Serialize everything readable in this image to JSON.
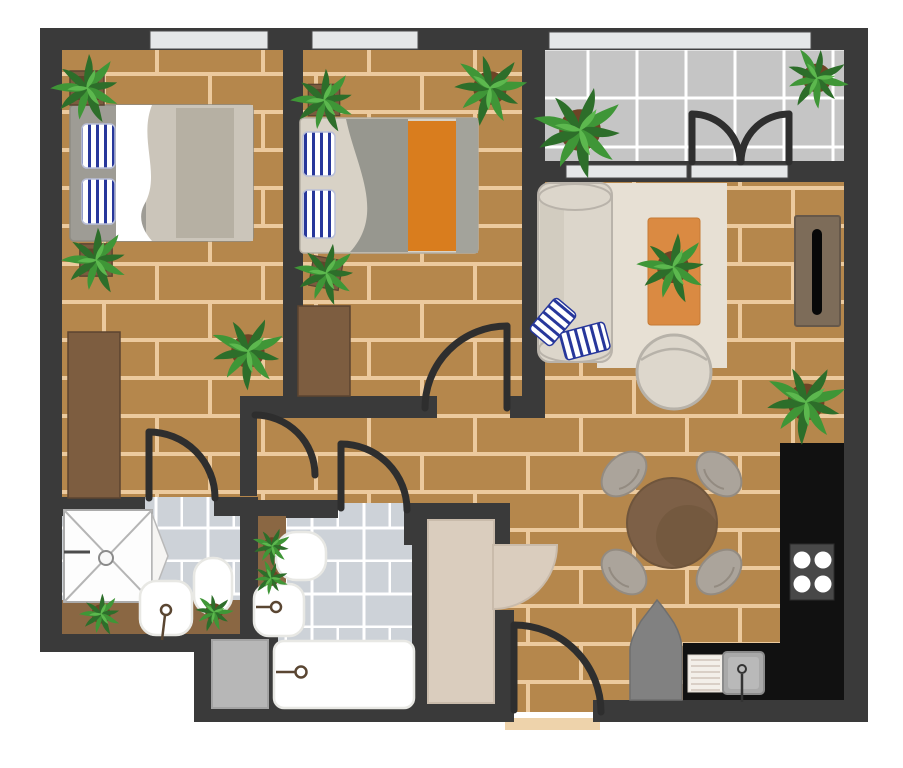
{
  "title": "Two-bedroom apartment floor plan (top-down illustration)",
  "palette": {
    "wall": "#3a3a3a",
    "door": "#2e2e2e",
    "floor-wood": "#b5874c",
    "floor-grout": "#ecca9e",
    "balcony-tile": "#c5c5c5",
    "bath-tile": "#cdd2d8",
    "tile-grout": "#ffffff",
    "window": "#e5e7e8",
    "bed-frame": "#9e9c95",
    "beige": "#d8d2c6",
    "beige-dark": "#b6b0a3",
    "gray-blanket": "#97978f",
    "orange": "#d97d1e",
    "rug": "#e7e0d4",
    "rug-orange": "#da8a42",
    "sofa": "#dcd6cb",
    "stripe-navy": "#27379b",
    "wood-furn": "#7d5d40",
    "tv-console": "#7d6c59",
    "counter": "#111111",
    "stove": "#484848",
    "chair": "#aba49b",
    "table": "#7d6047",
    "washer": "#b7b7b7",
    "closet": "#dacdbe",
    "gray-object": "#818181",
    "pot-round": "#6d4426",
    "pot-square": "#7b5b3e",
    "plant-dark": "#2d6e2a",
    "plant-mid": "#3f9637",
    "plant-light": "#5cb84e",
    "faucet": "#5a4632",
    "threshold": "#eed3ab"
  },
  "rooms": [
    {
      "name": "bedroom-1",
      "position": "top-left",
      "objects": [
        "double-bed",
        "striped-pillows-x2",
        "wardrobe",
        "window"
      ],
      "plants": 3
    },
    {
      "name": "bedroom-2",
      "position": "top-middle",
      "objects": [
        "double-bed",
        "striped-pillows-x2",
        "orange-runner-blanket",
        "dresser",
        "window"
      ],
      "plants": 3
    },
    {
      "name": "balcony",
      "position": "top-right",
      "objects": [
        "tiled-floor",
        "double-french-door",
        "window"
      ],
      "plants": 2
    },
    {
      "name": "living-room",
      "position": "right",
      "objects": [
        "sofa",
        "throw-pillows-x2",
        "area-rug",
        "papasan-chair",
        "tv-console"
      ],
      "plants": 2
    },
    {
      "name": "dining-area",
      "position": "center-right",
      "objects": [
        "round-table",
        "chairs-x4"
      ],
      "plants": 0
    },
    {
      "name": "kitchen",
      "position": "bottom-right",
      "objects": [
        "l-shaped-counter",
        "stove-4-burner",
        "sink-with-drainboard",
        "gray-cabinet"
      ],
      "plants": 0
    },
    {
      "name": "bathroom-1",
      "position": "bottom-left",
      "objects": [
        "shower",
        "pedestal-sink",
        "toilet",
        "vanity-shelf"
      ],
      "plants": 2
    },
    {
      "name": "bathroom-2",
      "position": "bottom-middle",
      "objects": [
        "toilet",
        "sink",
        "bathtub",
        "washing-machine",
        "shelf"
      ],
      "plants": 2
    },
    {
      "name": "entry-hall",
      "position": "bottom-center",
      "objects": [
        "closet",
        "closet-door",
        "entry-door"
      ],
      "plants": 0
    }
  ],
  "counts": {
    "plants": 14,
    "door-swings": 7,
    "windows": 3,
    "beds": 2,
    "bathrooms": 2
  }
}
